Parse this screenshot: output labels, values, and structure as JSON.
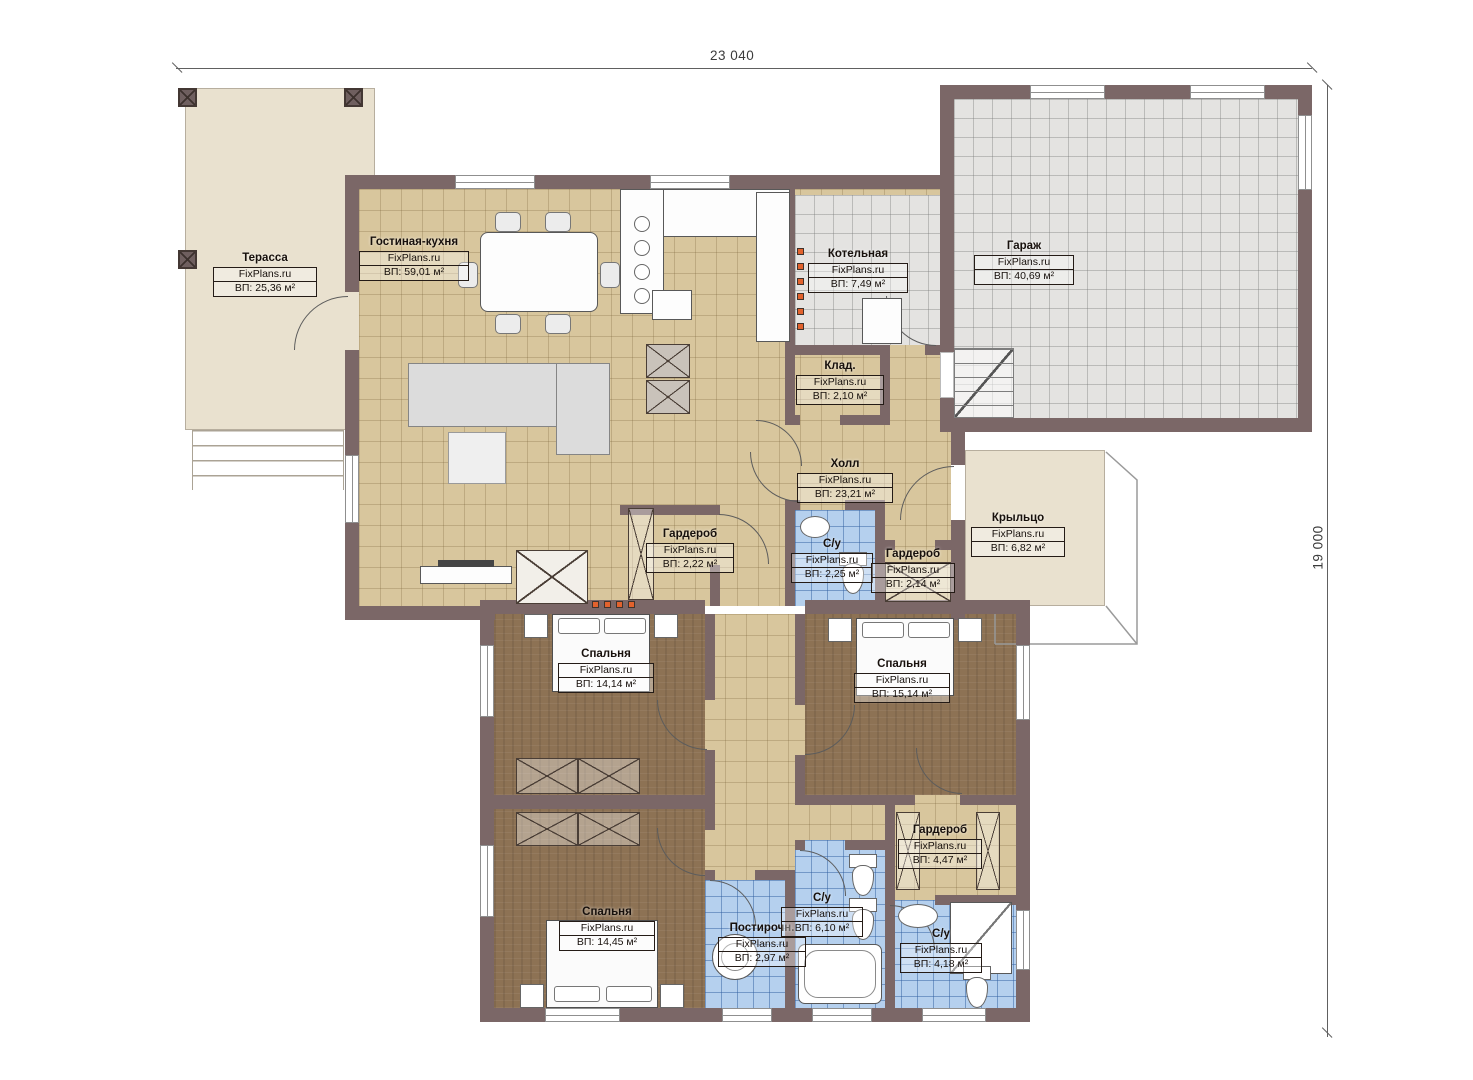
{
  "brand": "FixPlans.ru",
  "dimensions": {
    "width": "23 040",
    "height": "19 000"
  },
  "rooms": {
    "terrace": {
      "name": "Терасса",
      "area": "ВП: 25,36 м²"
    },
    "living_kitchen": {
      "name": "Гостиная-кухня",
      "area": "ВП: 59,01 м²"
    },
    "boiler": {
      "name": "Котельная",
      "area": "ВП: 7,49 м²"
    },
    "garage": {
      "name": "Гараж",
      "area": "ВП: 40,69 м²"
    },
    "storage": {
      "name": "Клад.",
      "area": "ВП: 2,10 м²"
    },
    "hall": {
      "name": "Холл",
      "area": "ВП: 23,21 м²"
    },
    "wardrobe_hall_left": {
      "name": "Гардероб",
      "area": "ВП: 2,22 м²"
    },
    "wc_hall": {
      "name": "С/у",
      "area": "ВП: 2,25 м²"
    },
    "wardrobe_hall_right": {
      "name": "Гардероб",
      "area": "ВП: 2,14 м²"
    },
    "porch": {
      "name": "Крыльцо",
      "area": "ВП: 6,82 м²"
    },
    "bedroom_left": {
      "name": "Спальня",
      "area": "ВП: 14,14 м²"
    },
    "bedroom_right": {
      "name": "Спальня",
      "area": "ВП: 15,14 м²"
    },
    "bedroom_bottom": {
      "name": "Спальня",
      "area": "ВП: 14,45 м²"
    },
    "laundry": {
      "name": "Постирочн.",
      "area": "ВП: 2,97 м²"
    },
    "bathroom_main": {
      "name": "С/у",
      "area": "ВП: 6,10 м²"
    },
    "wardrobe_master": {
      "name": "Гардероб",
      "area": "ВП: 4,47 м²"
    },
    "bathroom_master": {
      "name": "С/у",
      "area": "ВП: 4,18 м²"
    }
  },
  "colors": {
    "wall": "#7b6767",
    "floor_tile": "#d8c69d",
    "wet_tile": "#b5d0ee",
    "bedroom_floor": "#8d7254",
    "garage_tile": "#e4e3e1",
    "terrace": "#e9e1cf",
    "led_orange": "#e2622d"
  }
}
